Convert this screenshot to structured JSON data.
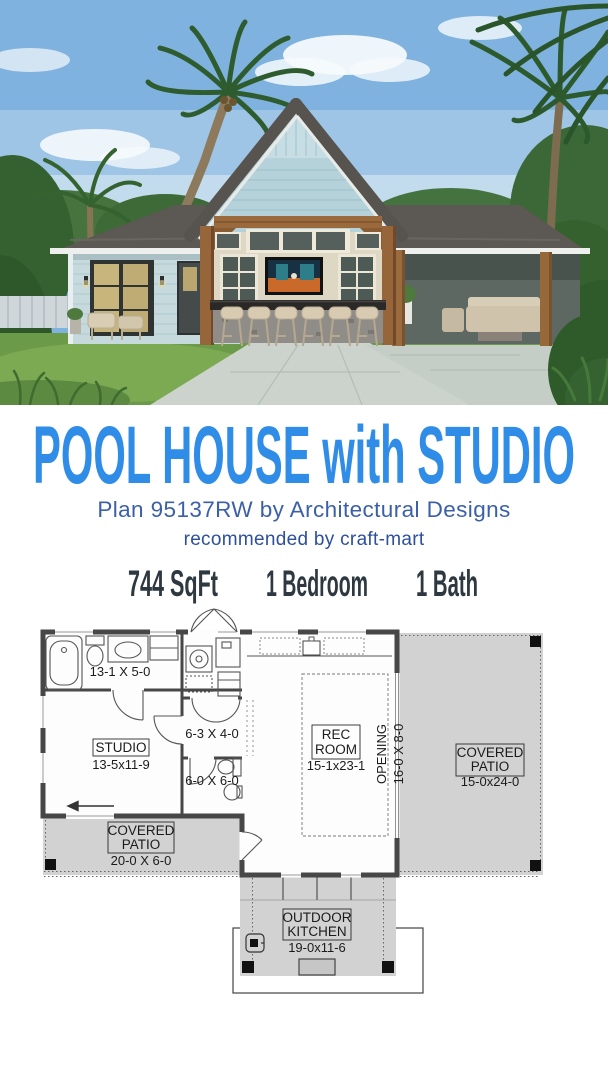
{
  "page": {
    "background": "#ffffff"
  },
  "hero": {
    "alt": "rendering of a coastal pool house with center gable, outdoor bar with six stools, wall TV, covered patios and palm trees",
    "colors": {
      "sky": "#7FB2DE",
      "roof": "#5C5853",
      "left_wing_siding": "#C6DADE",
      "gable_siding": "#B5D2DA",
      "wood_posts": "#96663A",
      "lawn": "#6B9A49",
      "walkway": "#CCD3CD"
    }
  },
  "title": {
    "text": "POOL HOUSE with STUDIO",
    "color": "#2F8DE8"
  },
  "subtitle": {
    "text": "Plan 95137RW by Architectural Designs",
    "color": "#3C60A8"
  },
  "attribution": {
    "text": "recommended by craft-mart",
    "color": "#2D4F9C"
  },
  "stats": {
    "color": "#2D3840",
    "sqft": "744 SqFt",
    "bedrooms": "1 Bedroom",
    "baths": "1 Bath"
  },
  "floor_plan": {
    "colors": {
      "wall": "#474747",
      "patio_fill": "#D2D2D2",
      "room_fill": "#FDFDFD",
      "text": "#1B1B1B"
    },
    "bath": {
      "dim": "13-1 X 5-0"
    },
    "studio": {
      "name": "STUDIO",
      "dim": "13-5x11-9"
    },
    "hall": {
      "dim": "6-3 X 4-0"
    },
    "powder": {
      "dim": "6-0 X 6-0"
    },
    "rec_room": {
      "line1": "REC",
      "line2": "ROOM",
      "dim": "15-1x23-1"
    },
    "opening": {
      "name": "OPENING",
      "dim": "16-0 X 8-0"
    },
    "patio_right": {
      "line1": "COVERED",
      "line2": "PATIO",
      "dim": "15-0x24-0"
    },
    "patio_left": {
      "line1": "COVERED",
      "line2": "PATIO",
      "dim": "20-0 X 6-0"
    },
    "outdoor_kitchen": {
      "line1": "OUTDOOR",
      "line2": "KITCHEN",
      "dim": "19-0x11-6"
    }
  }
}
